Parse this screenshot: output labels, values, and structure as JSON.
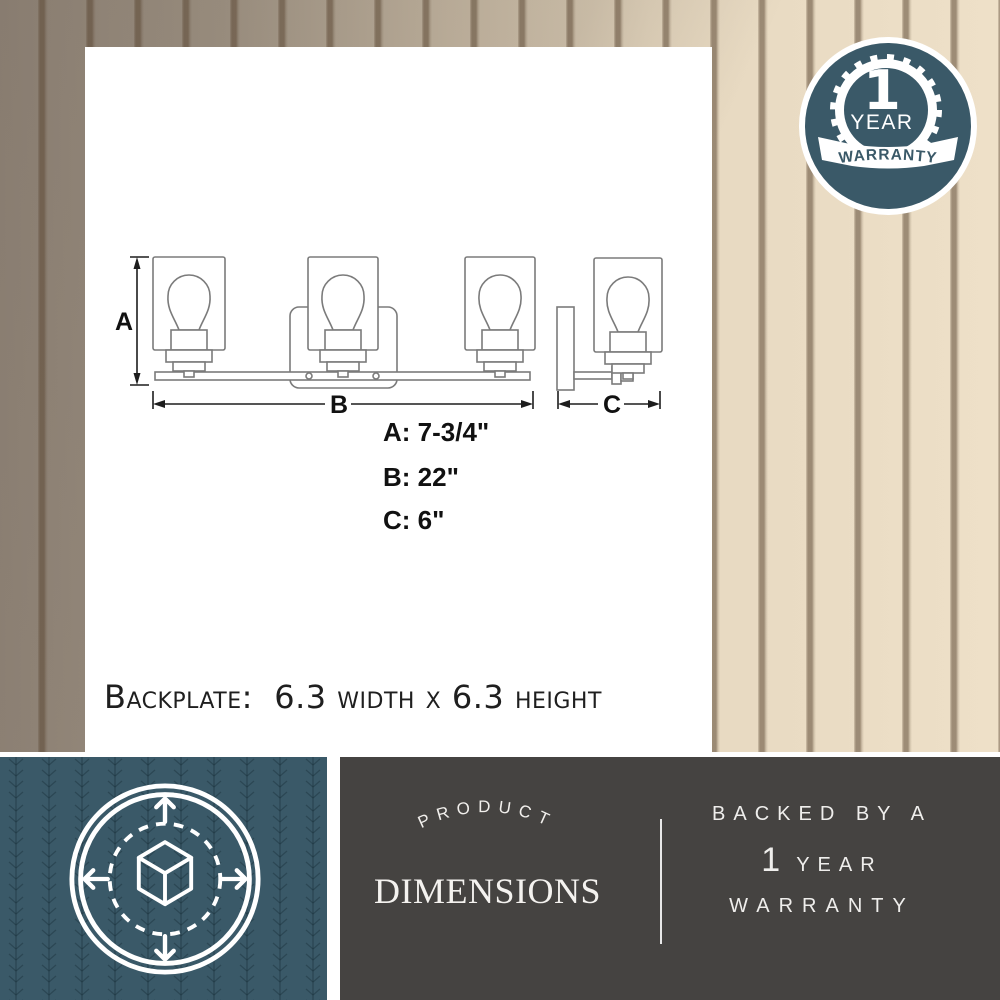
{
  "badge": {
    "number": "1",
    "year": "YEAR",
    "ribbon": "WARRANTY"
  },
  "diagram": {
    "label_a": "A",
    "label_b": "B",
    "label_c": "C",
    "dims": [
      {
        "text": "A: 7-3/4\""
      },
      {
        "text": "B: 22\""
      },
      {
        "text": "C: 6\""
      }
    ],
    "backplate_note": "Backplate:  6.3 width x 6.3 height"
  },
  "footer": {
    "product_word": "PRODUCT",
    "dimensions_word": "DIMENSIONS",
    "backed_by": "BACKED BY A",
    "year_number": "1",
    "year_word": "YEAR",
    "warranty_word": "WARRANTY"
  },
  "colors": {
    "teal": "#3a5968",
    "charcoal": "#454341",
    "wood_dark": "#9a8e81",
    "wood_light": "#ecdfc7"
  }
}
